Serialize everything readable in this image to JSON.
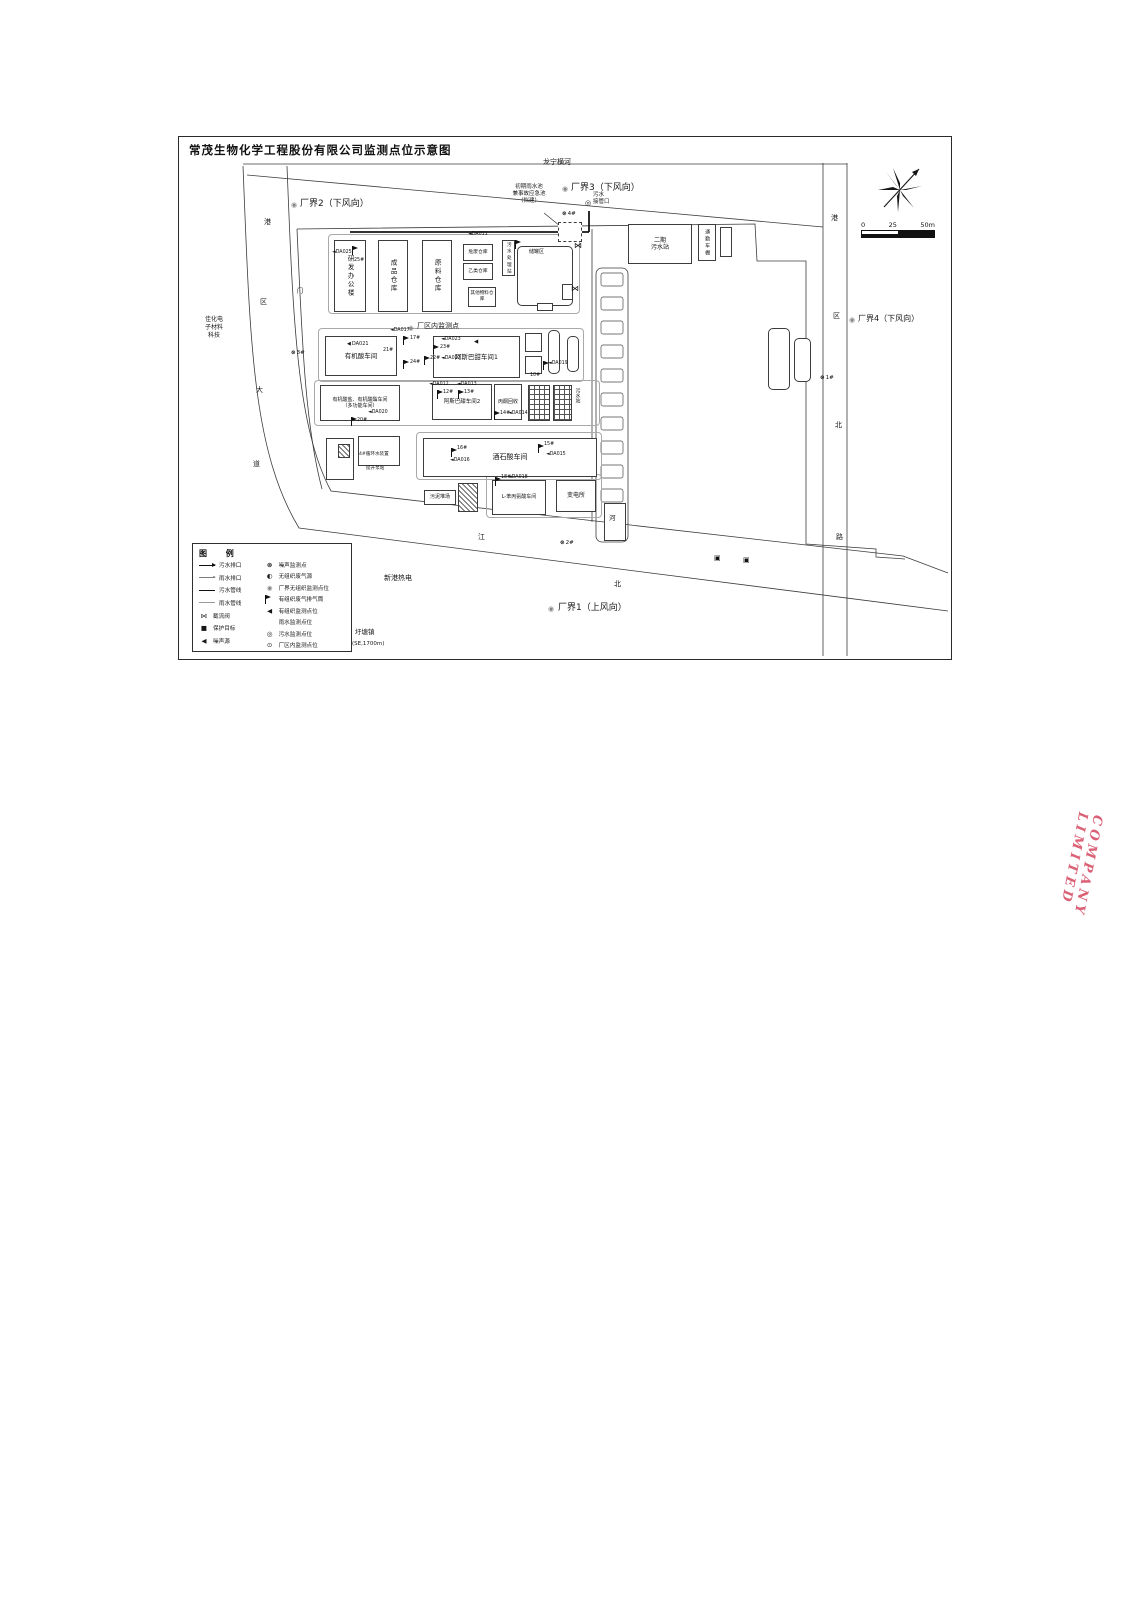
{
  "title": "常茂生物化学工程股份有限公司监测点位示意图",
  "stamp": {
    "text": "COMPANY LIMITED",
    "color": "#d64a63"
  },
  "scale_bar": {
    "labels": [
      "0",
      "25",
      "50m"
    ]
  },
  "glyphs": {
    "noise": "⊗",
    "bfug": "◉",
    "half": "◐",
    "organized": "◀",
    "sewage": "◎",
    "inplant": "⊙",
    "valve": "⋈",
    "target": "■",
    "outfall": "▣"
  },
  "legend": {
    "title": "图  例",
    "left": [
      {
        "name": "legend-sewage-outlet",
        "line": "arrow-solid",
        "label": "污水排口"
      },
      {
        "name": "legend-rain-outlet",
        "line": "arrow-thin",
        "label": "雨水排口"
      },
      {
        "name": "legend-sewage-pipe",
        "line": "line-solid",
        "label": "污水管线"
      },
      {
        "name": "legend-rain-pipe",
        "line": "line-thin",
        "label": "雨水管线"
      },
      {
        "name": "legend-cutoff-valve",
        "glyph": "valve",
        "label": "截流阀"
      },
      {
        "name": "legend-protection-target",
        "glyph": "target",
        "label": "保护目标"
      },
      {
        "name": "legend-noise-source",
        "glyph": "organized",
        "label": "噪声源"
      }
    ],
    "right": [
      {
        "name": "legend-noise-point",
        "glyph": "noise",
        "label": "噪声监测点"
      },
      {
        "name": "legend-fugitive-source",
        "glyph": "half",
        "label": "无组织废气源"
      },
      {
        "name": "legend-boundary-fugitive-point",
        "glyph": "bfug",
        "label": "厂界无组织监测点位"
      },
      {
        "name": "legend-stack",
        "glyph": "flag",
        "label": "有组织废气排气筒"
      },
      {
        "name": "legend-organized-point",
        "glyph": "organized",
        "label": "有组织监测点位"
      },
      {
        "name": "legend-rain-point",
        "glyph": "none",
        "label": "雨水监测点位"
      },
      {
        "name": "legend-sewage-point",
        "glyph": "sewage",
        "label": "污水监测点位"
      },
      {
        "name": "legend-inplant-point",
        "glyph": "inplant",
        "label": "厂区内监测点位"
      }
    ]
  },
  "buildings": [
    {
      "name": "pad-north-row",
      "label": "",
      "x": 328,
      "y": 234,
      "w": 252,
      "h": 80,
      "cls": "pad"
    },
    {
      "name": "pad-row2",
      "label": "",
      "x": 318,
      "y": 328,
      "w": 266,
      "h": 54,
      "cls": "pad"
    },
    {
      "name": "pad-row3",
      "label": "",
      "x": 314,
      "y": 380,
      "w": 286,
      "h": 46,
      "cls": "pad"
    },
    {
      "name": "pad-row4",
      "label": "",
      "x": 416,
      "y": 432,
      "w": 186,
      "h": 48,
      "cls": "pad"
    },
    {
      "name": "pad-row5",
      "label": "",
      "x": 486,
      "y": 474,
      "w": 116,
      "h": 44,
      "cls": "pad"
    },
    {
      "name": "rnd-office-building",
      "label": "研发办公楼",
      "x": 334,
      "y": 240,
      "w": 32,
      "h": 72,
      "cls": "v",
      "fs": 6.5
    },
    {
      "name": "finished-goods-warehouse",
      "label": "成品仓库",
      "x": 378,
      "y": 240,
      "w": 30,
      "h": 72,
      "cls": "v",
      "fs": 6.5
    },
    {
      "name": "raw-material-warehouse",
      "label": "原料仓库",
      "x": 422,
      "y": 240,
      "w": 30,
      "h": 72,
      "cls": "v",
      "fs": 6.5
    },
    {
      "name": "hazardous-waste-warehouse",
      "label": "危废仓库",
      "x": 463,
      "y": 244,
      "w": 30,
      "h": 17,
      "fs": 4.8
    },
    {
      "name": "class-b-warehouse",
      "label": "乙类仓库",
      "x": 463,
      "y": 263,
      "w": 30,
      "h": 17,
      "fs": 4.8
    },
    {
      "name": "wastewater-treatment-station",
      "label": "污水处理站",
      "x": 502,
      "y": 240,
      "w": 13,
      "h": 36,
      "cls": "v",
      "fs": 4.6
    },
    {
      "name": "other-materials-warehouse",
      "label": "其他物料仓库",
      "x": 468,
      "y": 287,
      "w": 28,
      "h": 20,
      "fs": 4.6
    },
    {
      "name": "tank-farm",
      "label": "",
      "x": 517,
      "y": 246,
      "w": 56,
      "h": 60,
      "cls": "rounded"
    },
    {
      "name": "tank-farm-small-box",
      "label": "",
      "x": 562,
      "y": 284,
      "w": 11,
      "h": 16
    },
    {
      "name": "tank-farm-pump-box",
      "label": "",
      "x": 537,
      "y": 303,
      "w": 16,
      "h": 8
    },
    {
      "name": "initial-rainwater-pond",
      "label": "",
      "x": 558,
      "y": 222,
      "w": 24,
      "h": 20,
      "cls": "dashed"
    },
    {
      "name": "phase2-wwtp",
      "label": "二期\n污水站",
      "x": 628,
      "y": 224,
      "w": 64,
      "h": 40,
      "fs": 6
    },
    {
      "name": "commuter-shed",
      "label": "通勤车棚",
      "x": 698,
      "y": 224,
      "w": 18,
      "h": 37,
      "cls": "v",
      "fs": 5
    },
    {
      "name": "small-shed",
      "label": "",
      "x": 720,
      "y": 227,
      "w": 12,
      "h": 30
    },
    {
      "name": "organic-acid-workshop",
      "label": "有机酸车间",
      "x": 325,
      "y": 336,
      "w": 72,
      "h": 40,
      "fs": 6.5
    },
    {
      "name": "aspartame-workshop-1",
      "label": "阿斯巴甜车间1",
      "x": 433,
      "y": 336,
      "w": 87,
      "h": 42,
      "fs": 6.5
    },
    {
      "name": "utility-box-a",
      "label": "",
      "x": 525,
      "y": 333,
      "w": 17,
      "h": 19
    },
    {
      "name": "utility-box-b",
      "label": "",
      "x": 525,
      "y": 356,
      "w": 17,
      "h": 18
    },
    {
      "name": "tower-a",
      "label": "",
      "x": 548,
      "y": 330,
      "w": 12,
      "h": 44,
      "cls": "rounded"
    },
    {
      "name": "tower-b",
      "label": "",
      "x": 567,
      "y": 336,
      "w": 12,
      "h": 36,
      "cls": "rounded"
    },
    {
      "name": "organic-acid-salt-ester-workshop",
      "label": "有机酸盐、有机酸酯车间\n（多功能车间）",
      "x": 320,
      "y": 385,
      "w": 80,
      "h": 36,
      "fs": 5
    },
    {
      "name": "aspartame-workshop-2",
      "label": "阿斯巴甜车间2",
      "x": 432,
      "y": 384,
      "w": 60,
      "h": 36,
      "fs": 5.5
    },
    {
      "name": "acetone-recovery",
      "label": "丙酮回收",
      "x": 494,
      "y": 384,
      "w": 28,
      "h": 36,
      "fs": 5
    },
    {
      "name": "wwtp-grid-a",
      "label": "",
      "x": 528,
      "y": 385,
      "w": 22,
      "h": 36,
      "cls": "grid"
    },
    {
      "name": "wwtp-grid-b",
      "label": "",
      "x": 553,
      "y": 385,
      "w": 19,
      "h": 36,
      "cls": "grid"
    },
    {
      "name": "gatehouse",
      "label": "",
      "x": 326,
      "y": 438,
      "w": 28,
      "h": 42
    },
    {
      "name": "gatehouse-inner",
      "label": "",
      "x": 338,
      "y": 444,
      "w": 12,
      "h": 14,
      "cls": "hatch"
    },
    {
      "name": "circulating-water-station",
      "label": "",
      "x": 358,
      "y": 436,
      "w": 42,
      "h": 30
    },
    {
      "name": "tartaric-acid-workshop",
      "label": "酒石酸车间",
      "x": 423,
      "y": 438,
      "w": 174,
      "h": 39,
      "fs": 7
    },
    {
      "name": "sludge-yard-sign",
      "label": "污泥堆场",
      "x": 424,
      "y": 490,
      "w": 32,
      "h": 15,
      "fs": 5
    },
    {
      "name": "sludge-yard-hatch",
      "label": "",
      "x": 458,
      "y": 483,
      "w": 20,
      "h": 29,
      "cls": "hatch"
    },
    {
      "name": "l-phenylalanine-workshop",
      "label": "L-苯丙氨酸车间",
      "x": 492,
      "y": 480,
      "w": 54,
      "h": 35,
      "fs": 5
    },
    {
      "name": "substation",
      "label": "变电所",
      "x": 556,
      "y": 480,
      "w": 40,
      "h": 32,
      "fs": 6
    },
    {
      "name": "river-box",
      "label": "",
      "x": 604,
      "y": 503,
      "w": 22,
      "h": 38
    },
    {
      "name": "east-shed-a",
      "label": "",
      "x": 768,
      "y": 328,
      "w": 22,
      "h": 62,
      "cls": "rounded"
    },
    {
      "name": "east-shed-b",
      "label": "",
      "x": 794,
      "y": 338,
      "w": 17,
      "h": 44,
      "cls": "rounded"
    }
  ],
  "markers": [
    {
      "name": "boundary2-point",
      "glyph": "bfug",
      "x": 291,
      "y": 202,
      "fs": 7
    },
    {
      "name": "boundary3-point",
      "glyph": "bfug",
      "x": 562,
      "y": 186,
      "fs": 7
    },
    {
      "name": "boundary4-point",
      "glyph": "bfug",
      "x": 849,
      "y": 317,
      "fs": 7
    },
    {
      "name": "boundary1-point",
      "glyph": "bfug",
      "x": 548,
      "y": 606,
      "fs": 7
    },
    {
      "name": "inplant-point",
      "glyph": "bfug",
      "x": 408,
      "y": 325,
      "fs": 6.5
    },
    {
      "name": "noise-point-4",
      "glyph": "noise",
      "label": "4#",
      "x": 562,
      "y": 212,
      "fs": 5.5
    },
    {
      "name": "noise-point-3",
      "glyph": "noise",
      "label": "3#",
      "x": 291,
      "y": 351,
      "fs": 5.5
    },
    {
      "name": "noise-point-2",
      "glyph": "noise",
      "label": "2#",
      "x": 560,
      "y": 541,
      "fs": 5.5
    },
    {
      "name": "noise-point-1",
      "glyph": "noise",
      "label": "1#",
      "x": 820,
      "y": 376,
      "fs": 5.5
    },
    {
      "name": "sewage-connection-point",
      "glyph": "sewage",
      "x": 585,
      "y": 200,
      "fs": 7
    },
    {
      "name": "cutoff-valve-1",
      "glyph": "valve",
      "x": 574,
      "y": 242,
      "fs": 8
    },
    {
      "name": "cutoff-valve-2",
      "glyph": "valve",
      "x": 571,
      "y": 285,
      "fs": 8
    },
    {
      "name": "outfall-square-1",
      "glyph": "outfall",
      "x": 714,
      "y": 555,
      "fs": 7
    },
    {
      "name": "outfall-square-2",
      "glyph": "outfall",
      "x": 743,
      "y": 557,
      "fs": 7
    },
    {
      "name": "protection-target-square",
      "glyph": "target",
      "x": 344,
      "y": 645,
      "fs": 6
    },
    {
      "name": "stack-da025",
      "glyph": "flag",
      "x": 352,
      "y": 246
    },
    {
      "name": "stack-da011",
      "glyph": "flag",
      "x": 515,
      "y": 240
    },
    {
      "name": "stack-da017",
      "glyph": "flag",
      "x": 403,
      "y": 336
    },
    {
      "name": "stack-da024",
      "glyph": "flag",
      "x": 403,
      "y": 360
    },
    {
      "name": "stack-da023",
      "glyph": "flag",
      "x": 433,
      "y": 345
    },
    {
      "name": "stack-da022",
      "glyph": "flag",
      "x": 424,
      "y": 356
    },
    {
      "name": "stack-da020",
      "glyph": "flag",
      "x": 351,
      "y": 417
    },
    {
      "name": "stack-da012",
      "glyph": "flag",
      "x": 437,
      "y": 390
    },
    {
      "name": "stack-da013",
      "glyph": "flag",
      "x": 458,
      "y": 390
    },
    {
      "name": "stack-da014",
      "glyph": "flag",
      "x": 494,
      "y": 411
    },
    {
      "name": "stack-da016",
      "glyph": "flag",
      "x": 451,
      "y": 448
    },
    {
      "name": "stack-da015",
      "glyph": "flag",
      "x": 538,
      "y": 444
    },
    {
      "name": "stack-da018",
      "glyph": "flag",
      "x": 495,
      "y": 477
    },
    {
      "name": "stack-da019",
      "glyph": "flag",
      "x": 543,
      "y": 361
    },
    {
      "name": "label-da025",
      "label": "◄DA025",
      "x": 332,
      "y": 251,
      "fs": 4.8
    },
    {
      "name": "label-25",
      "label": "25#",
      "x": 354,
      "y": 259,
      "fs": 4.8
    },
    {
      "name": "label-da011",
      "label": "◄DA011",
      "x": 468,
      "y": 233,
      "fs": 4.8
    },
    {
      "name": "label-da017",
      "label": "◄DA017",
      "x": 390,
      "y": 329,
      "fs": 4.8
    },
    {
      "name": "label-17",
      "label": "17#",
      "x": 410,
      "y": 337,
      "fs": 4.8
    },
    {
      "name": "label-24",
      "label": "24#",
      "x": 410,
      "y": 361,
      "fs": 4.8
    },
    {
      "name": "label-da023",
      "label": "◄DA023",
      "x": 441,
      "y": 338,
      "fs": 4.8
    },
    {
      "name": "label-23",
      "label": "23#",
      "x": 440,
      "y": 346,
      "fs": 4.8
    },
    {
      "name": "label-22",
      "label": "22#",
      "x": 430,
      "y": 357,
      "fs": 4.8
    },
    {
      "name": "label-da022",
      "label": "◄DA022",
      "x": 441,
      "y": 357,
      "fs": 4.8
    },
    {
      "name": "label-da021",
      "glyph": "organized",
      "label": "DA021",
      "x": 347,
      "y": 342,
      "fs": 5
    },
    {
      "name": "label-21",
      "label": "21#",
      "x": 383,
      "y": 349,
      "fs": 4.8
    },
    {
      "name": "aspartame1-noise-source",
      "glyph": "organized",
      "x": 474,
      "y": 340,
      "fs": 5.5
    },
    {
      "name": "label-da020",
      "label": "◄DA020",
      "x": 368,
      "y": 411,
      "fs": 4.8
    },
    {
      "name": "label-20",
      "label": "20#",
      "x": 357,
      "y": 419,
      "fs": 4.8
    },
    {
      "name": "label-da012",
      "label": "◄DA012",
      "x": 429,
      "y": 383,
      "fs": 4.8
    },
    {
      "name": "label-da013",
      "label": "◄DA013",
      "x": 457,
      "y": 383,
      "fs": 4.8
    },
    {
      "name": "label-12",
      "label": "12#",
      "x": 443,
      "y": 391,
      "fs": 4.8
    },
    {
      "name": "label-13",
      "label": "13#",
      "x": 464,
      "y": 391,
      "fs": 4.8
    },
    {
      "name": "label-14",
      "label": "14#",
      "x": 500,
      "y": 412,
      "fs": 4.8
    },
    {
      "name": "label-da014",
      "label": "◄DA014",
      "x": 508,
      "y": 412,
      "fs": 4.8
    },
    {
      "name": "label-16",
      "label": "16#",
      "x": 457,
      "y": 447,
      "fs": 4.8
    },
    {
      "name": "label-da016",
      "label": "◄DA016",
      "x": 450,
      "y": 459,
      "fs": 4.8
    },
    {
      "name": "label-15",
      "label": "15#",
      "x": 544,
      "y": 443,
      "fs": 4.8
    },
    {
      "name": "label-da015",
      "label": "◄DA015",
      "x": 546,
      "y": 453,
      "fs": 4.8
    },
    {
      "name": "label-18",
      "label": "18#",
      "x": 501,
      "y": 476,
      "fs": 4.8
    },
    {
      "name": "label-da018",
      "label": "◄DA018",
      "x": 508,
      "y": 476,
      "fs": 4.8
    },
    {
      "name": "label-da019",
      "label": "◄DA019",
      "x": 548,
      "y": 362,
      "fs": 4.8
    },
    {
      "name": "label-10",
      "label": "10#",
      "x": 530,
      "y": 374,
      "fs": 4.8
    }
  ],
  "labels": [
    {
      "name": "river-north-name",
      "text": "龙宁横河",
      "x": 543,
      "y": 158,
      "fs": 7
    },
    {
      "name": "boundary2-label",
      "text": "厂界2（下风向）",
      "x": 300,
      "y": 199,
      "fs": 9
    },
    {
      "name": "boundary3-label",
      "text": "厂界3（下风向）",
      "x": 571,
      "y": 183,
      "fs": 9
    },
    {
      "name": "boundary4-label",
      "text": "厂界4（下风向）",
      "x": 858,
      "y": 314,
      "fs": 8
    },
    {
      "name": "boundary1-label",
      "text": "厂界1（上风向）",
      "x": 558,
      "y": 603,
      "fs": 9
    },
    {
      "name": "initial-rainpond-label",
      "text": "初期雨水池\n兼事故应急池\n（拟建）",
      "x": 500,
      "y": 184,
      "fs": 5.5,
      "cls": "ctr",
      "w": 58
    },
    {
      "name": "sewage-connection-label",
      "text": "污水\n接管口",
      "x": 593,
      "y": 192,
      "fs": 5.5
    },
    {
      "name": "inplant-point-label",
      "text": "厂区内监测点",
      "x": 417,
      "y": 322,
      "fs": 7
    },
    {
      "name": "neighbor-west-label",
      "text": "佳化电\n子材料\n科技",
      "x": 196,
      "y": 316,
      "fs": 6,
      "cls": "ctr",
      "w": 36
    },
    {
      "name": "neighbor-south-label",
      "text": "新港热电",
      "x": 384,
      "y": 574,
      "fs": 7
    },
    {
      "name": "yutang-town-label",
      "text": "圩塘镇",
      "x": 355,
      "y": 628,
      "fs": 6.5
    },
    {
      "name": "yutang-distance-label",
      "text": "(SE,1700m)",
      "x": 352,
      "y": 641,
      "fs": 5.5
    },
    {
      "name": "road-west-char-1",
      "text": "港",
      "x": 264,
      "y": 218,
      "fs": 7
    },
    {
      "name": "road-west-char-2",
      "text": "区",
      "x": 260,
      "y": 298,
      "fs": 7
    },
    {
      "name": "road-west-char-3",
      "text": "大",
      "x": 256,
      "y": 386,
      "fs": 7
    },
    {
      "name": "road-west-char-4",
      "text": "道",
      "x": 253,
      "y": 460,
      "fs": 7
    },
    {
      "name": "road-east-char-1",
      "text": "港",
      "x": 831,
      "y": 214,
      "fs": 7
    },
    {
      "name": "road-east-char-2",
      "text": "区",
      "x": 833,
      "y": 312,
      "fs": 7
    },
    {
      "name": "road-east-char-3",
      "text": "北",
      "x": 835,
      "y": 421,
      "fs": 7
    },
    {
      "name": "road-east-char-4",
      "text": "路",
      "x": 836,
      "y": 533,
      "fs": 7
    },
    {
      "name": "road-south-char-1",
      "text": "江",
      "x": 478,
      "y": 533,
      "fs": 7
    },
    {
      "name": "road-south-char-2",
      "text": "北",
      "x": 614,
      "y": 580,
      "fs": 7
    },
    {
      "name": "river-east-char",
      "text": "河",
      "x": 609,
      "y": 514,
      "fs": 6.5
    },
    {
      "name": "west-gate-char",
      "text": "门",
      "x": 297,
      "y": 288,
      "fs": 6
    },
    {
      "name": "tank-farm-label",
      "text": "储罐区",
      "x": 529,
      "y": 249,
      "fs": 5
    },
    {
      "name": "circulating-water-label",
      "text": "4#循环水装置",
      "x": 359,
      "y": 452,
      "fs": 4.6
    },
    {
      "name": "lift-pump-label",
      "text": "提升泵站",
      "x": 366,
      "y": 466,
      "fs": 4.6
    },
    {
      "name": "wwtp-label",
      "text": "污水站",
      "x": 574,
      "y": 388,
      "fs": 5,
      "cls": "vert"
    }
  ]
}
